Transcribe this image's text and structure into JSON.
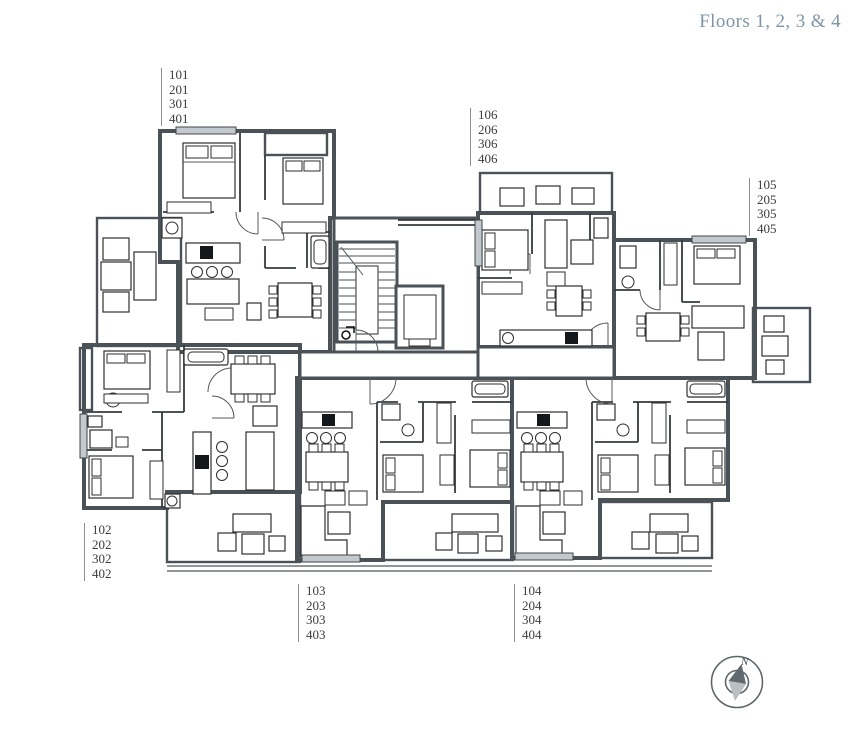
{
  "title": "Floors 1, 2, 3 & 4",
  "units": {
    "u101": {
      "lines": [
        "101",
        "201",
        "301",
        "401"
      ]
    },
    "u102": {
      "lines": [
        "102",
        "202",
        "302",
        "402"
      ]
    },
    "u103": {
      "lines": [
        "103",
        "203",
        "303",
        "403"
      ]
    },
    "u104": {
      "lines": [
        "104",
        "204",
        "304",
        "404"
      ]
    },
    "u105": {
      "lines": [
        "105",
        "205",
        "305",
        "405"
      ]
    },
    "u106": {
      "lines": [
        "106",
        "206",
        "306",
        "406"
      ]
    }
  },
  "compass": {
    "north_label": "N"
  },
  "colors": {
    "title_text": "#7d95a8",
    "label_text": "#3c3c3c",
    "leader_line": "#8f8f8f",
    "apartment_pink": "#e7dce2",
    "apartment_beige": "#e2ded2",
    "apartment_blue": "#d6dee6",
    "apartment_green": "#d8e6db",
    "balcony_bg": "#cfd3d6",
    "balcony_stripe": "#8f979c",
    "wall": "#4a5257"
  }
}
